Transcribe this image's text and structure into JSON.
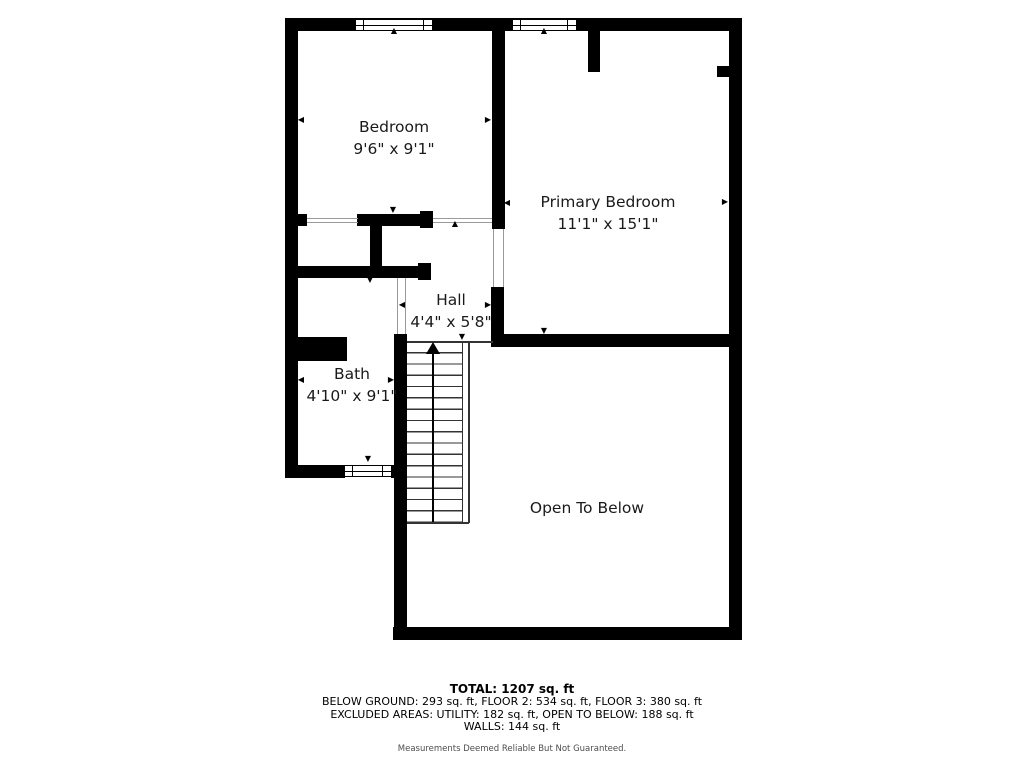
{
  "rooms": {
    "bedroom": {
      "name": "Bedroom",
      "dims": "9'6\" x 9'1\""
    },
    "primary_bedroom": {
      "name": "Primary Bedroom",
      "dims": "11'1\" x 15'1\""
    },
    "hall": {
      "name": "Hall",
      "dims": "4'4\" x 5'8\""
    },
    "bath": {
      "name": "Bath",
      "dims": "4'10\" x 9'1\""
    },
    "open_to_below": {
      "name": "Open To Below",
      "dims": ""
    }
  },
  "summary": {
    "total": "TOTAL: 1207 sq. ft",
    "floors": "BELOW GROUND: 293 sq. ft, FLOOR 2: 534 sq. ft, FLOOR 3: 380 sq. ft",
    "excluded": "EXCLUDED AREAS: UTILITY: 182 sq. ft, OPEN TO BELOW: 188 sq. ft",
    "walls": "WALLS: 144 sq. ft",
    "disclaimer": "Measurements Deemed Reliable But Not Guaranteed."
  },
  "icons": {
    "up": "▲",
    "down": "▼",
    "left": "◀",
    "right": "▶"
  },
  "colors": {
    "wall": "#000000",
    "background": "#ffffff",
    "opening_line": "#9a9a9a",
    "stair_line": "#333333"
  }
}
